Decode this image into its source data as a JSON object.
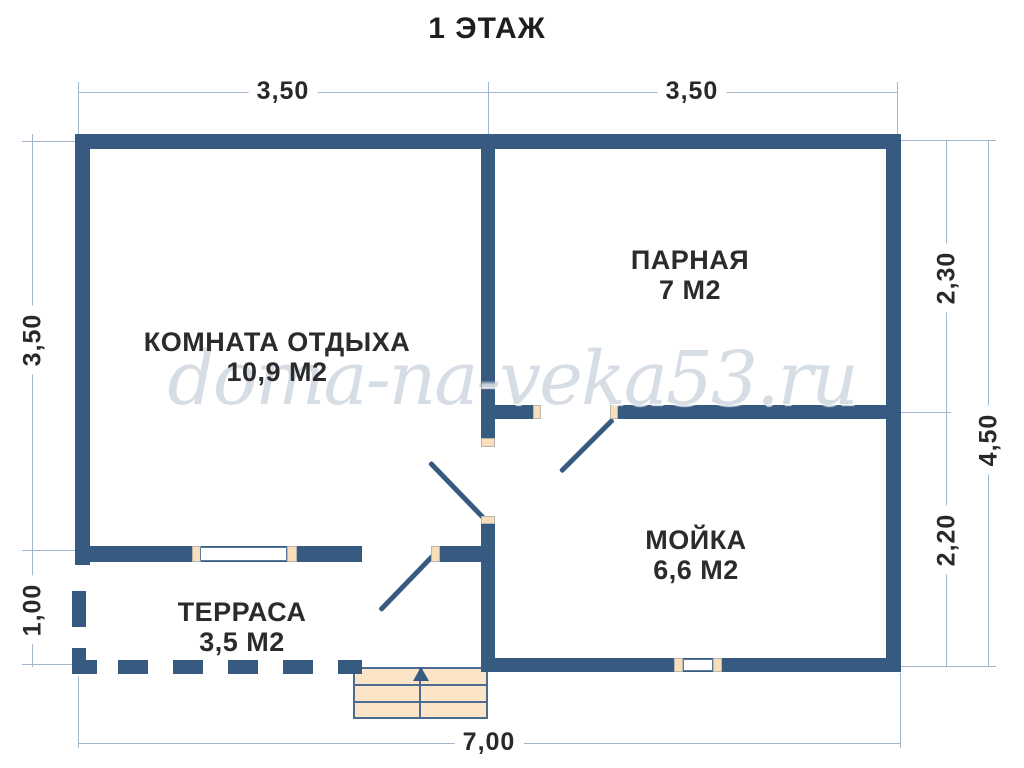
{
  "title": "1 ЭТАЖ",
  "watermark": "doma-na-veka53.ru",
  "rooms": [
    {
      "name": "КОМНАТА ОТДЫХА",
      "area": "10,9 М2"
    },
    {
      "name": "ПАРНАЯ",
      "area": "7 М2"
    },
    {
      "name": "МОЙКА",
      "area": "6,6 М2"
    },
    {
      "name": "ТЕРРАСА",
      "area": "3,5 М2"
    }
  ],
  "dimensions": {
    "top_left": "3,50",
    "top_right": "3,50",
    "left_upper": "3,50",
    "left_lower": "1,00",
    "right_upper": "2,30",
    "right_lower": "2,20",
    "right_total": "4,50",
    "bottom_total": "7,00"
  },
  "features": {
    "windows": 2,
    "doors": 3,
    "stairs_direction": "up"
  },
  "colors": {
    "wall": "#375a80",
    "opening_jamb": "#f8dfba",
    "stairs_fill": "#fce5c7",
    "stairs_border": "#4b6b92",
    "dimension_line": "#9fb6cc",
    "text": "#28292b",
    "background": "#ffffff"
  }
}
